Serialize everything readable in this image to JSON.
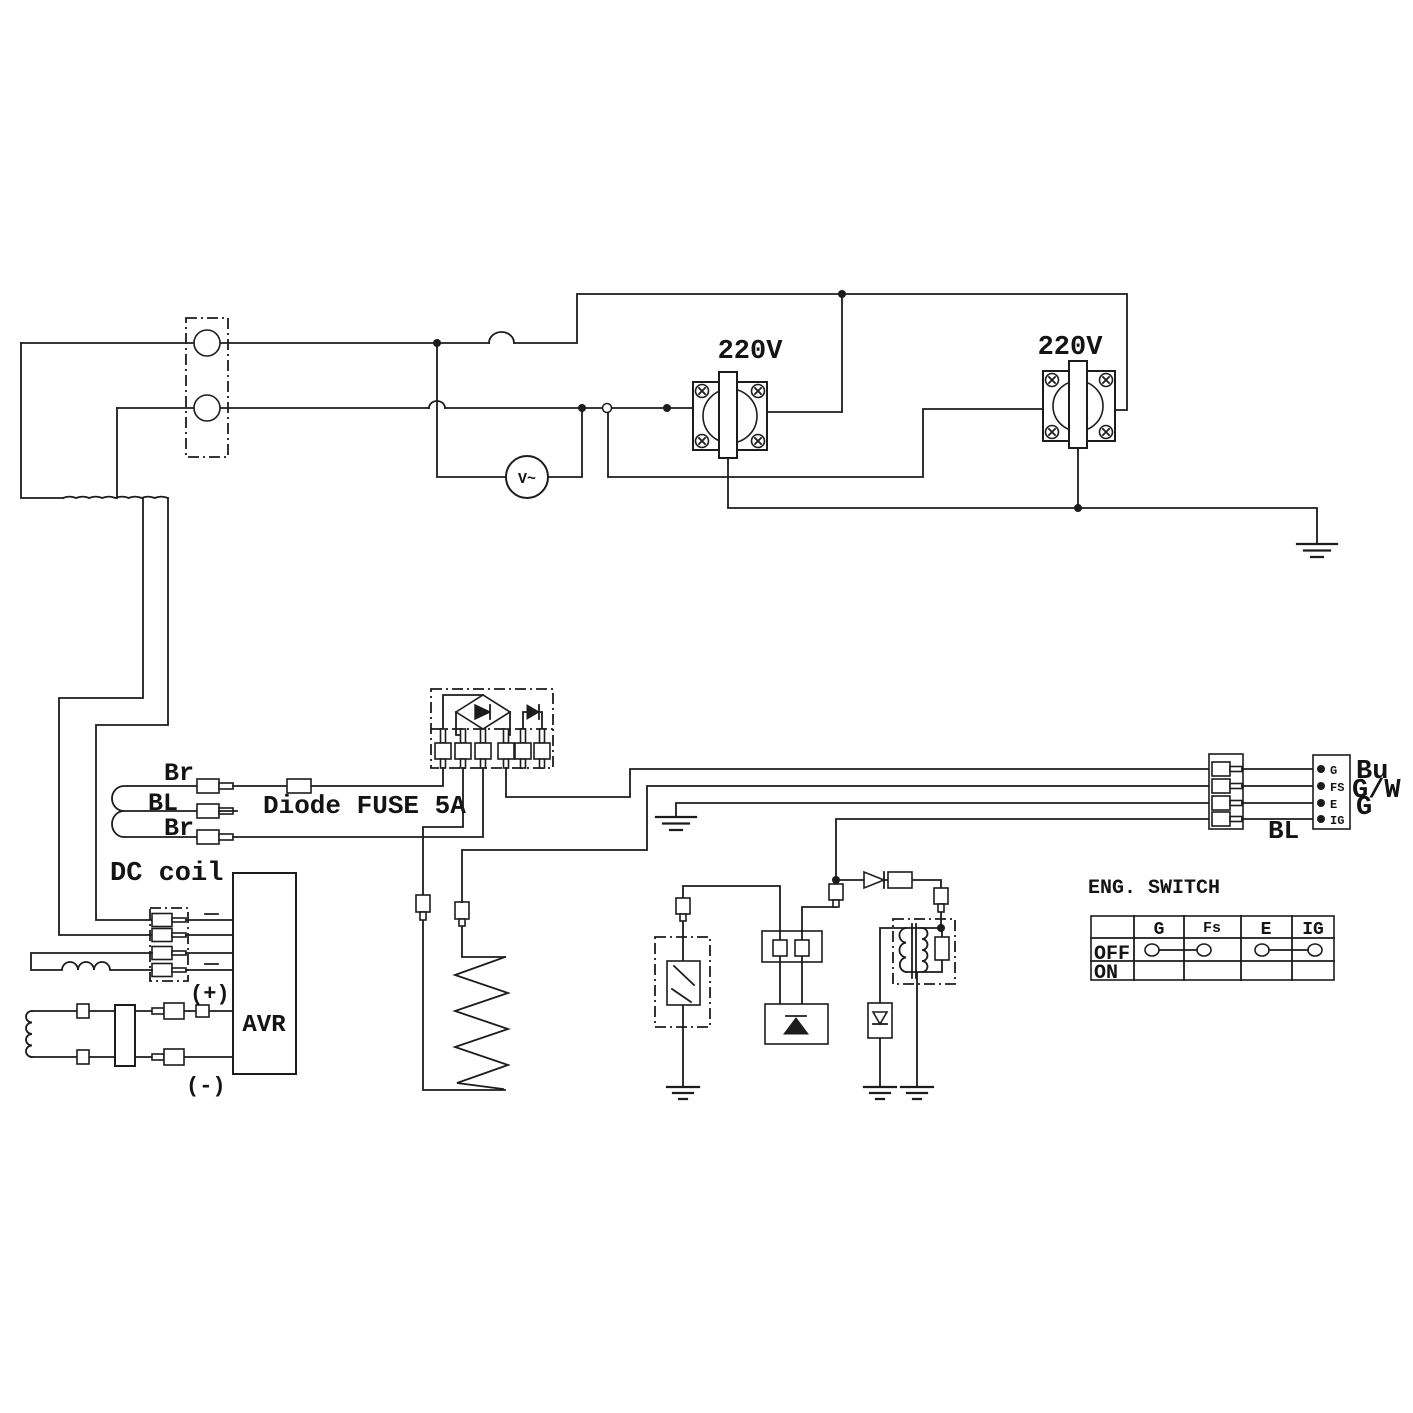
{
  "colors": {
    "ink": "#1c1c1c",
    "background": "#ffffff"
  },
  "outlets": {
    "left_label": "220V",
    "right_label": "220V"
  },
  "voltmeter": {
    "label": "V~"
  },
  "generator": {
    "wire_top": "Br",
    "wire_mid": "BL",
    "wire_bottom": "Br",
    "fuse_label": "Diode FUSE 5A",
    "dc_coil_label": "DC coil"
  },
  "avr": {
    "label": "AVR",
    "plus": "(+)",
    "minus": "(-)"
  },
  "coupler": {
    "pin_labels": [
      "G",
      "FS",
      "E",
      "IG"
    ],
    "wire_labels": [
      "Bu",
      "G/W",
      "G"
    ],
    "bl_label": "BL"
  },
  "eng_switch": {
    "title": "ENG. SWITCH",
    "columns": [
      "G",
      "Fs",
      "E",
      "IG"
    ],
    "rows": [
      "OFF",
      "ON"
    ],
    "off_row_connections": [
      [
        "G",
        "Fs"
      ],
      [
        "E",
        "IG"
      ]
    ]
  }
}
